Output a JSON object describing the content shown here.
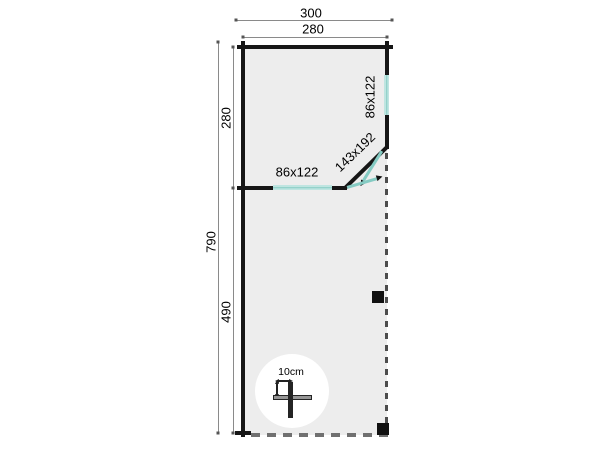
{
  "drawing": {
    "type": "floor-plan",
    "dim_width_outer": "300",
    "dim_width_inner": "280",
    "dim_height_outer": "790",
    "dim_height_upper": "280",
    "dim_height_lower": "490",
    "window_front_label": "86x122",
    "window_side_label": "86x122",
    "door_label": "143x192",
    "detail_label": "10cm",
    "colors": {
      "background": "#ffffff",
      "wall": "#161616",
      "floor": "#ededed",
      "window": "#bfe5e1",
      "window_line": "#85cbc3",
      "dimension_line": "#8a8a8a",
      "dashed_edge": "#4d4d4d"
    }
  }
}
